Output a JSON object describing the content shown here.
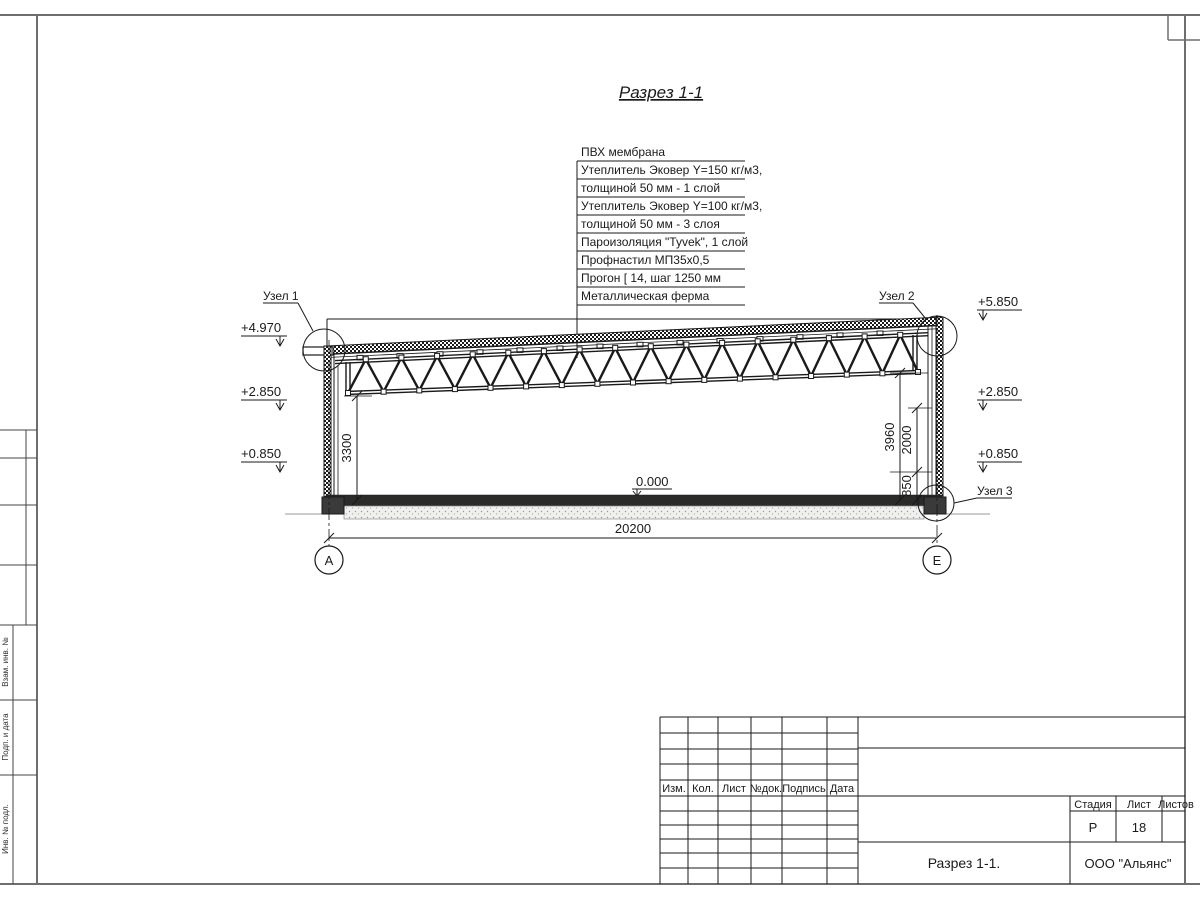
{
  "page": {
    "title": "Разрез 1-1"
  },
  "materials": {
    "lines": [
      "ПВХ мембрана",
      "Утеплитель Эковер Y=150 кг/м3,",
      "толщиной 50 мм - 1 слой",
      "Утеплитель Эковер Y=100 кг/м3,",
      "толщиной 50 мм - 3 слоя",
      "Пароизоляция \"Tyvek\", 1 слой",
      "Профнастил МП35х0,5",
      "Прогон [ 14, шаг 1250 мм",
      "Металлическая ферма"
    ]
  },
  "elevations": {
    "left_top": "+4.970",
    "left_mid": "+2.850",
    "left_low": "+0.850",
    "right_top": "+5.850",
    "right_mid": "+2.850",
    "right_low": "+0.850",
    "floor": "0.000"
  },
  "nodes": {
    "n1": "Узел 1",
    "n2": "Узел 2",
    "n3": "Узел 3"
  },
  "dimensions": {
    "span": "20200",
    "left_height": "3300",
    "right_height": "3960",
    "mid_height": "2000",
    "low_height": "850"
  },
  "axes": {
    "left": "А",
    "right": "Е"
  },
  "titleblock": {
    "rev_headers": [
      "Изм.",
      "Кол.",
      "Лист",
      "№док.",
      "Подпись",
      "Дата"
    ],
    "stage_label": "Стадия",
    "sheet_label": "Лист",
    "sheets_label": "Листов",
    "stage": "Р",
    "sheet": "18",
    "drawing_title": "Разрез 1-1.",
    "company": "ООО \"Альянс\""
  },
  "side_column": {
    "labels": [
      "Взам. инв. №",
      "Подп. и дата",
      "Инв. № подл."
    ]
  },
  "colors": {
    "line": "#1a1a1a",
    "frame": "#6e6e6e",
    "ground": "#999999"
  }
}
